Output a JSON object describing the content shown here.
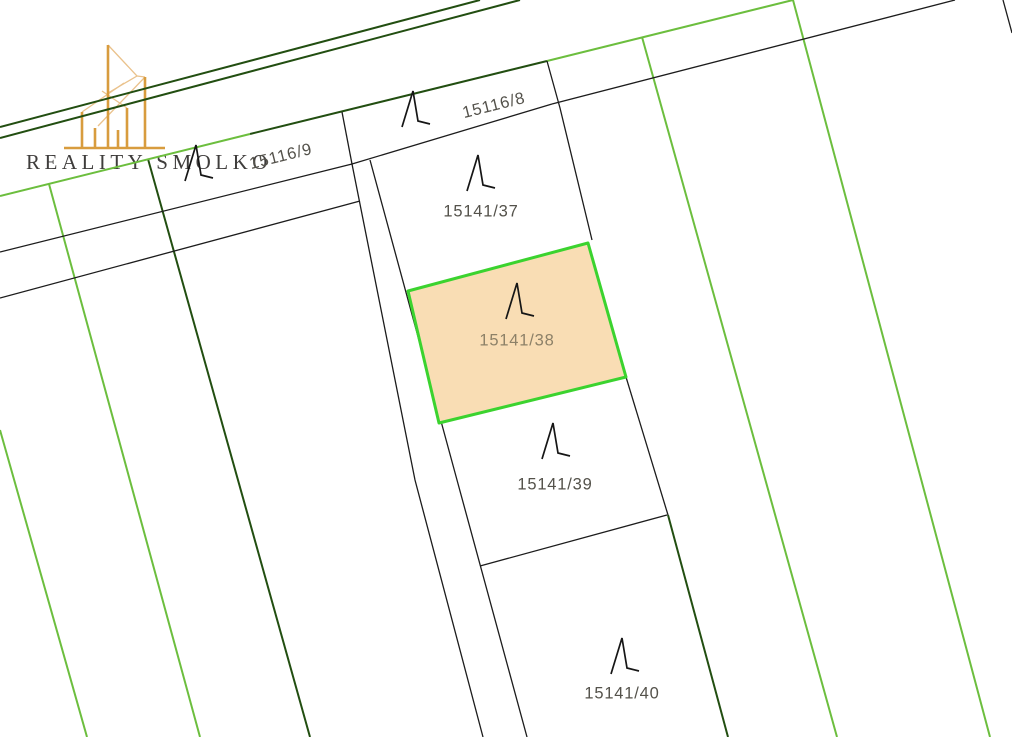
{
  "logo": {
    "brand": "REALITY SMOLKO",
    "icon": "buildings-skyline-icon",
    "gold_color": "#D89C3E",
    "light_gold_color": "#EAC28C",
    "text_color": "#3F3D3C"
  },
  "map": {
    "type": "cadastral-parcel-map",
    "line_colors": {
      "black": "#1C1C1C",
      "dark_green": "#224E11",
      "bright_green": "#6CBE3E"
    },
    "highlight": {
      "fill": "#F9DDB4",
      "border": "#3BD32F",
      "label_color": "#8D8168"
    },
    "parcels": [
      {
        "label": "15116/9",
        "highlighted": false,
        "symbol": "grassland-symbol"
      },
      {
        "label": "15116/8",
        "highlighted": false,
        "symbol": "grassland-symbol"
      },
      {
        "label": "15141/37",
        "highlighted": false,
        "symbol": "grassland-symbol"
      },
      {
        "label": "15141/38",
        "highlighted": true,
        "symbol": "grassland-symbol"
      },
      {
        "label": "15141/39",
        "highlighted": false,
        "symbol": "grassland-symbol"
      },
      {
        "label": "15141/40",
        "highlighted": false,
        "symbol": "grassland-symbol"
      }
    ]
  }
}
